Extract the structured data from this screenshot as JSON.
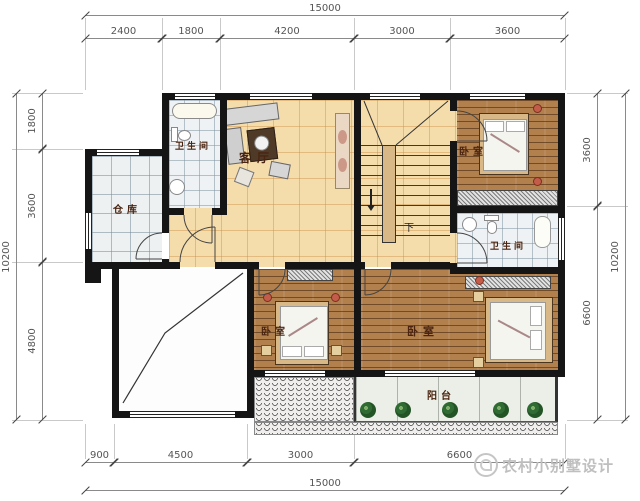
{
  "dims": {
    "top_total": "15000",
    "top": [
      "2400",
      "1800",
      "4200",
      "3000",
      "3600"
    ],
    "left_total": "10200",
    "left": [
      "1800",
      "3600",
      "4800"
    ],
    "right": [
      "3600",
      "6600"
    ],
    "right_total": "10200",
    "bottom": [
      "900",
      "4500",
      "3000",
      "6600"
    ],
    "bottom_total": "15000"
  },
  "rooms": {
    "bathroom_top": "卫生间",
    "storage": "仓库",
    "living": "客厅",
    "bedroom_topright": "卧室",
    "bathroom_right": "卫生间",
    "bedroom_bottom_small": "卧室",
    "bedroom_bottom_large": "卧室",
    "balcony": "阳台",
    "stairs_down": "下"
  },
  "watermark": {
    "text": "农村小别墅设计"
  },
  "colors": {
    "wall": "#151515",
    "hall_floor": "#f5dcab",
    "wood_floor": "#b2804d",
    "tile_floor": "#eef2f4",
    "balcony_floor": "#ecefe8",
    "room_label": "#4a2410",
    "dim_text": "#555555"
  }
}
